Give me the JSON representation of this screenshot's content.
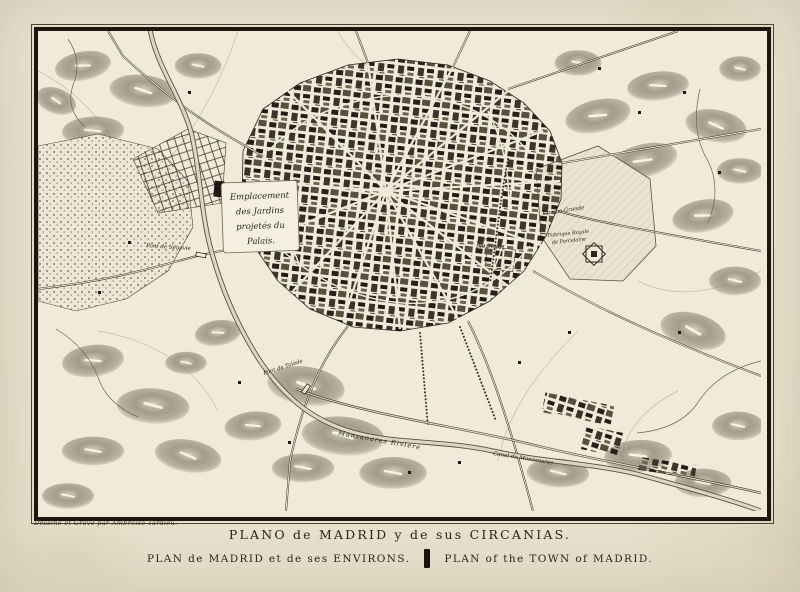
{
  "page": {
    "title_line1": "PLANO de MADRID y de sus CIRCANIAS.",
    "subtitle_left": "PLAN de MADRID et de ses ENVIRONS.",
    "subtitle_right": "PLAN of the TOWN of MADRID.",
    "credit": "Dessiné et Gravé par Ambroise Tardieu."
  },
  "map": {
    "cartouche": {
      "line1": "Emplacement",
      "line2": "des Jardins",
      "line3": "projetés du",
      "line4": "Palais."
    },
    "labels": {
      "river": "Manzanares Riviere",
      "canal": "Canal de Manzanares",
      "bridge_segovia": "Pont de Ségovie",
      "bridge_toledo": "Pont de Tolède",
      "botanic_1": "Jardin",
      "botanic_2": "Botanique",
      "campo": "Campo Grande",
      "porcelain_1": "Fabrique Royale",
      "porcelain_2": "de Porcelaine"
    },
    "colors": {
      "paper_margin": "#eae3d0",
      "map_paper": "#f0ead9",
      "ink": "#27221a",
      "hill_gray": "#8a8370"
    }
  }
}
